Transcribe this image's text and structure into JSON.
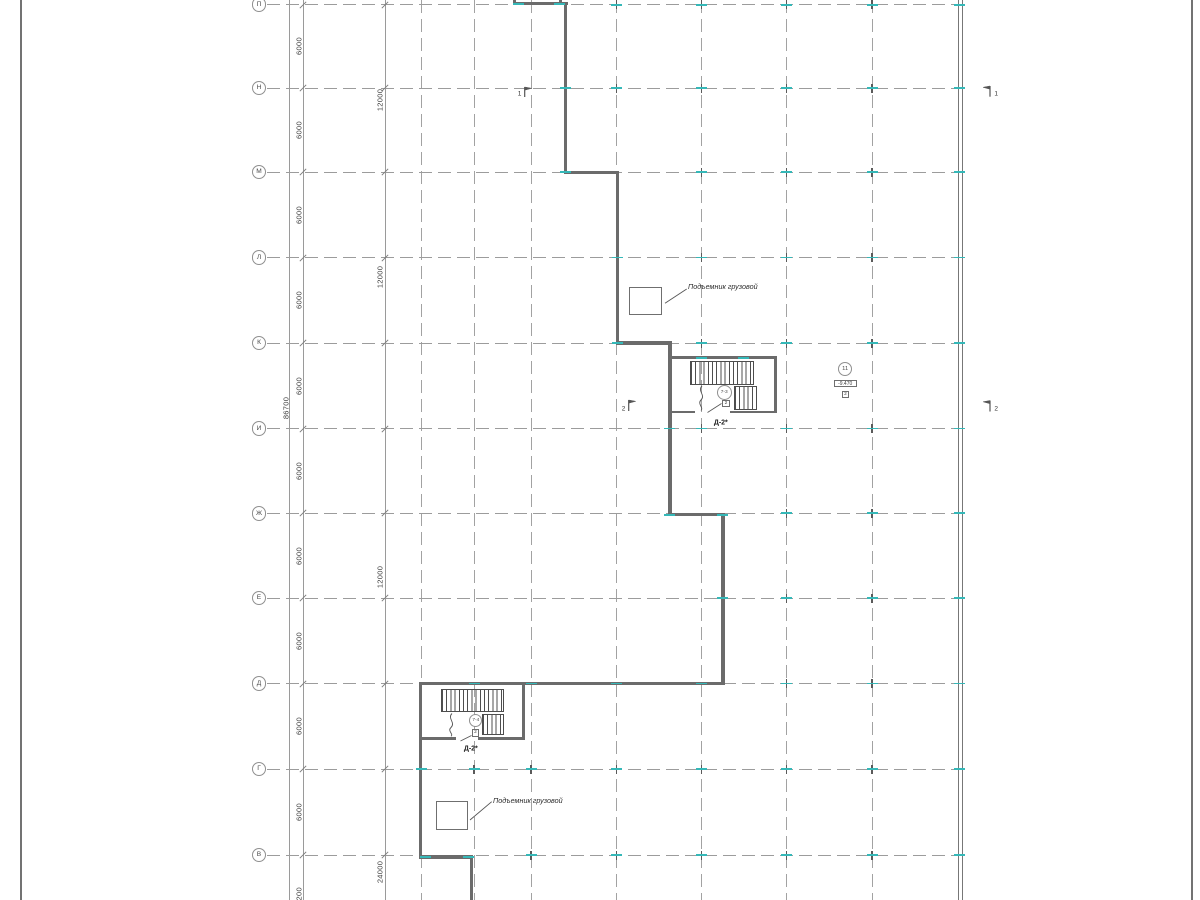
{
  "drawing": {
    "colors": {
      "wall": "#6b6b6b",
      "cyan": "#35b8b8",
      "grid": "#9c9c9c",
      "text": "#3e3e3e",
      "line": "#555555"
    },
    "axes": {
      "bubble_x": 259,
      "bubble_d": 14.6,
      "line_x1": 267,
      "line_x2": 955,
      "rows": [
        {
          "label": "П",
          "y": 4.7
        },
        {
          "label": "Н",
          "y": 88
        },
        {
          "label": "М",
          "y": 172
        },
        {
          "label": "Л",
          "y": 257.5
        },
        {
          "label": "К",
          "y": 343
        },
        {
          "label": "И",
          "y": 428.5
        },
        {
          "label": "Ж",
          "y": 513.3
        },
        {
          "label": "Е",
          "y": 598
        },
        {
          "label": "Д",
          "y": 683.5
        },
        {
          "label": "Г",
          "y": 769
        },
        {
          "label": "В",
          "y": 855
        }
      ]
    },
    "grid": {
      "columns_x": [
        421.5,
        474,
        531,
        616.5,
        701.5,
        786.5,
        872
      ],
      "dim_lines_x": [
        289,
        303,
        385
      ],
      "slash_x": [
        303,
        385
      ]
    },
    "page_borders": [
      {
        "x": 20,
        "w": 1.8
      },
      {
        "x": 1191.3,
        "w": 1.5
      }
    ],
    "right_wall": {
      "x": 957.8,
      "w": 3.4
    },
    "dim_texts": [
      {
        "text": "86700",
        "x": 285.5,
        "y": 408
      },
      {
        "text": "6000",
        "x": 298.5,
        "y": 46.4
      },
      {
        "text": "6000",
        "x": 298.5,
        "y": 130
      },
      {
        "text": "6000",
        "x": 298.5,
        "y": 214.5
      },
      {
        "text": "6000",
        "x": 298.5,
        "y": 300
      },
      {
        "text": "6000",
        "x": 298.5,
        "y": 385.5
      },
      {
        "text": "6000",
        "x": 298.5,
        "y": 470.7
      },
      {
        "text": "6000",
        "x": 298.5,
        "y": 555.6
      },
      {
        "text": "6000",
        "x": 298.5,
        "y": 640.7
      },
      {
        "text": "6000",
        "x": 298.5,
        "y": 726.3
      },
      {
        "text": "6000",
        "x": 298.5,
        "y": 812
      },
      {
        "text": "12000",
        "x": 380.3,
        "y": 100
      },
      {
        "text": "12000",
        "x": 380.3,
        "y": 277
      },
      {
        "text": "12000",
        "x": 380.3,
        "y": 577
      },
      {
        "text": "24000",
        "x": 380.3,
        "y": 871.5
      },
      {
        "text": "7200",
        "x": 298.5,
        "y": 896
      }
    ],
    "walls": [
      [
        513,
        2.2,
        54.5,
        3.2
      ],
      [
        513,
        0,
        3.2,
        2.2
      ],
      [
        558.5,
        0,
        3.2,
        2.2
      ],
      [
        563.8,
        2.2,
        3.2,
        171.5
      ],
      [
        563.8,
        170.5,
        55.2,
        3.4
      ],
      [
        615.6,
        170.5,
        3.4,
        174.2
      ],
      [
        615.6,
        341.3,
        56.1,
        3.4
      ],
      [
        668.3,
        341.3,
        3.4,
        175.1
      ],
      [
        668.3,
        513,
        56.5,
        3.4
      ],
      [
        721.4,
        513,
        3.4,
        172.2
      ],
      [
        419,
        681.8,
        305.8,
        3.4
      ],
      [
        419,
        681.8,
        3.4,
        177
      ],
      [
        419,
        855.4,
        54,
        3.4
      ],
      [
        469.8,
        855.4,
        3.2,
        44.6
      ],
      [
        668.3,
        356.3,
        108.6,
        2.8
      ],
      [
        773.9,
        356.3,
        3,
        57.2
      ],
      [
        668.3,
        410.7,
        27,
        2.8
      ],
      [
        729.5,
        410.7,
        47.4,
        2.8
      ],
      [
        521.8,
        685.2,
        3,
        54.6
      ],
      [
        419,
        736.8,
        37,
        2.8
      ],
      [
        478,
        736.8,
        46.8,
        2.8
      ]
    ],
    "flights": [
      [
        689.5,
        360.5,
        64,
        24.5
      ],
      [
        733.5,
        385.8,
        23.5,
        24.2
      ],
      [
        440.5,
        688.5,
        63,
        23.5
      ],
      [
        481.5,
        713.5,
        22.5,
        21
      ]
    ],
    "landing_lines": [
      [
        689.5,
        384.2,
        64,
        1
      ],
      [
        440.5,
        711.2,
        63,
        1
      ]
    ],
    "rails": [
      "M702,386 C697,391 706,395 701,400 C697,404 704,407.5 701,410.5",
      "M452,713.5 C447,718.5 456,722.5 451,727.5 C447,731 454,734 451,736.3"
    ],
    "stair_annotations": [
      {
        "circle": "7-3",
        "cx": 724.2,
        "cy": 392.5,
        "cd": 15,
        "box": "2",
        "bx": 726,
        "by": 403.6,
        "bs": 7.4,
        "label": "Д-2*",
        "lx": 720.8,
        "ly": 422.8,
        "leader": [
          721.5,
          403.5,
          707.5,
          412.5
        ]
      },
      {
        "circle": "7-4",
        "cx": 475.8,
        "cy": 720.8,
        "cd": 13,
        "box": "2",
        "bx": 475.5,
        "by": 733,
        "bs": 7.4,
        "label": "Д-2*",
        "lx": 470.8,
        "ly": 748.6,
        "leader": [
          471.5,
          735.5,
          460.5,
          741
        ]
      }
    ],
    "hoists": [
      {
        "label": "Подъемник грузовой",
        "rect": [
          629,
          286.7,
          32.6,
          28.6
        ],
        "leader": [
          665,
          303.3,
          686.7,
          289
        ],
        "tx": 688,
        "ty": 281.8
      },
      {
        "label": "Подъемник грузовой",
        "rect": [
          435.7,
          800.7,
          32.6,
          29.3
        ],
        "leader": [
          470,
          820,
          491.7,
          801.7
        ],
        "tx": 493,
        "ty": 795.8
      }
    ],
    "level_mark": {
      "num": "11",
      "cx": 845.2,
      "cy": 369,
      "cd": 14,
      "elev": "-9.470",
      "ex": 845.2,
      "ey": 383.8,
      "ew": 23,
      "eh": 7.4,
      "box": "2",
      "bx": 845.5,
      "by": 394.3,
      "bs": 7.6
    },
    "section_marks": [
      {
        "num": "1",
        "x": 524.7,
        "y0": 87,
        "y1": 97,
        "dir": 1,
        "nx": 519.5,
        "ny": 94.3
      },
      {
        "num": "2",
        "x": 628.7,
        "y0": 400,
        "y1": 411,
        "dir": 1,
        "nx": 623.5,
        "ny": 409.3
      },
      {
        "num": "1",
        "x": 990,
        "y0": 86,
        "y1": 96.7,
        "dir": -1,
        "nx": 996.2,
        "ny": 93.8
      },
      {
        "num": "2",
        "x": 990,
        "y0": 400.5,
        "y1": 411.5,
        "dir": -1,
        "nx": 996.2,
        "ny": 408.5
      }
    ],
    "wall_ticks": [
      [
        518.5,
        3.8
      ],
      [
        559.5,
        3.8
      ],
      [
        565.4,
        88
      ],
      [
        565.4,
        172.2
      ],
      [
        617.3,
        257.5
      ],
      [
        617.3,
        343
      ],
      [
        669.9,
        428.5
      ],
      [
        669.9,
        514.7
      ],
      [
        722.9,
        514.7
      ],
      [
        701.5,
        357.7
      ],
      [
        743,
        357.7
      ],
      [
        722.9,
        598
      ],
      [
        474,
        683.5
      ],
      [
        531,
        683.5
      ],
      [
        616.5,
        683.5
      ],
      [
        701.5,
        683.5
      ],
      [
        421.7,
        769
      ],
      [
        425,
        857.1
      ],
      [
        468,
        857.1
      ],
      [
        959.5,
        4.7
      ],
      [
        959.5,
        88
      ],
      [
        959.5,
        172
      ],
      [
        959.5,
        257.5
      ],
      [
        959.5,
        343
      ],
      [
        959.5,
        428.5
      ],
      [
        959.5,
        513.3
      ],
      [
        959.5,
        598
      ],
      [
        959.5,
        683.5
      ],
      [
        959.5,
        769
      ],
      [
        959.5,
        855
      ]
    ],
    "grid_ticks": [
      [
        616.5,
        4.7
      ],
      [
        701.5,
        4.7
      ],
      [
        786.5,
        4.7
      ],
      [
        872,
        4.7
      ],
      [
        616.5,
        88
      ],
      [
        701.5,
        88
      ],
      [
        786.5,
        88
      ],
      [
        872,
        88
      ],
      [
        701.5,
        172
      ],
      [
        786.5,
        172
      ],
      [
        872,
        172
      ],
      [
        701.5,
        257.5
      ],
      [
        786.5,
        257.5
      ],
      [
        872,
        257.5
      ],
      [
        701.5,
        343
      ],
      [
        786.5,
        343
      ],
      [
        872,
        343
      ],
      [
        701.5,
        428.5
      ],
      [
        786.5,
        428.5
      ],
      [
        872,
        428.5
      ],
      [
        786.5,
        513.3
      ],
      [
        872,
        513.3
      ],
      [
        786.5,
        598
      ],
      [
        872,
        598
      ],
      [
        786.5,
        683.5
      ],
      [
        872,
        683.5
      ],
      [
        474,
        769
      ],
      [
        531,
        769
      ],
      [
        616.5,
        769
      ],
      [
        701.5,
        769
      ],
      [
        786.5,
        769
      ],
      [
        872,
        769
      ],
      [
        531,
        855
      ],
      [
        616.5,
        855
      ],
      [
        701.5,
        855
      ],
      [
        786.5,
        855
      ],
      [
        872,
        855
      ]
    ]
  }
}
